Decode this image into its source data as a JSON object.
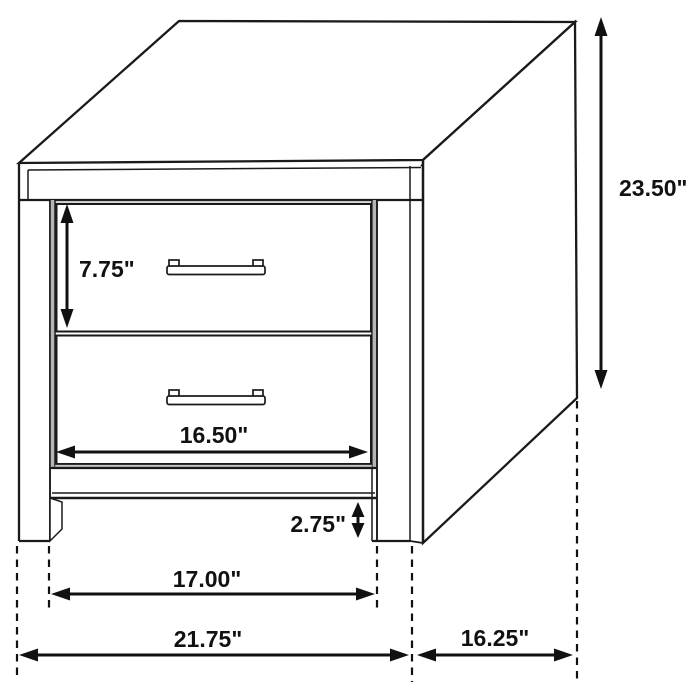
{
  "diagram": {
    "subject": "nightstand-two-drawer-dimension-diagram",
    "background_color": "#ffffff",
    "line_color": "#1a1a1a",
    "labels": {
      "overall_height": "23.50\"",
      "drawer_height": "7.75\"",
      "drawer_width": "16.50\"",
      "base_clearance": "2.75\"",
      "leg_inner_span": "17.00\"",
      "overall_width": "21.75\"",
      "overall_depth": "16.25\""
    }
  }
}
